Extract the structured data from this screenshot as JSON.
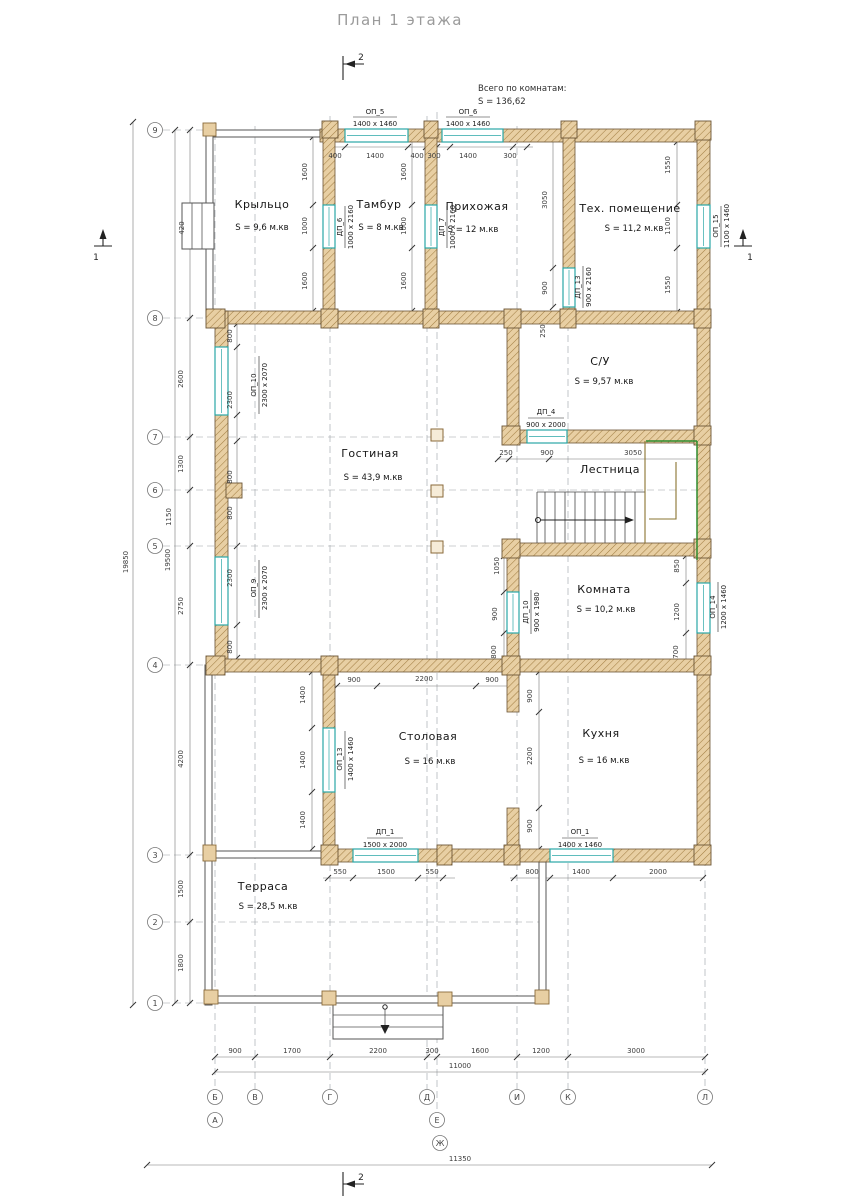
{
  "title": "План 1 этажа",
  "summary": {
    "line1": "Всего по комнатам:",
    "line2": "S   =   136,62"
  },
  "markers": {
    "top": "2",
    "bottom": "2",
    "right": "1",
    "left": "1"
  },
  "axes": {
    "rows": [
      "9",
      "8",
      "7",
      "6",
      "5",
      "4",
      "3",
      "2",
      "1"
    ],
    "cols": [
      "Б",
      "В",
      "Г",
      "Д",
      "И",
      "К",
      "Л"
    ],
    "cols_row2": [
      "А",
      "Е"
    ],
    "col_extra": "Ж"
  },
  "rooms": {
    "krylco": {
      "name": "Крыльцо",
      "area": "S  =  9,6 м.кв"
    },
    "tambur": {
      "name": "Тамбур",
      "area": "S  =  8 м.кв"
    },
    "prihozhaya": {
      "name": "Прихожая",
      "area": "S  =  12 м.кв"
    },
    "tehpom": {
      "name": "Тех. помещение",
      "area": "S  =  11,2 м.кв"
    },
    "su": {
      "name": "С/У",
      "area": "S  =  9,57 м.кв"
    },
    "gostinaya": {
      "name": "Гостиная",
      "area": "S  =  43,9 м.кв"
    },
    "lestnitsa": {
      "name": "Лестница"
    },
    "komnata": {
      "name": "Комната",
      "area": "S  =  10,2 м.кв"
    },
    "stolovaya": {
      "name": "Столовая",
      "area": "S  =  16 м.кв"
    },
    "kuhnya": {
      "name": "Кухня",
      "area": "S  =  16 м.кв"
    },
    "terrasa": {
      "name": "Терраса",
      "area": "S  =  28,5 м.кв"
    }
  },
  "openings": {
    "op5": {
      "name": "ОП_5",
      "size": "1400 x 1460"
    },
    "op6": {
      "name": "ОП_6",
      "size": "1400 x 1460"
    },
    "op15": {
      "name": "ОП_15",
      "size": "1100 x 1460"
    },
    "op10": {
      "name": "ОП_10",
      "size": "2300 x 2070"
    },
    "op9": {
      "name": "ОП_9",
      "size": "2300 x 2070"
    },
    "op14": {
      "name": "ОП_14",
      "size": "1200 x 1460"
    },
    "op13": {
      "name": "ОП_13",
      "size": "1400 x 1460"
    },
    "op1": {
      "name": "ОП_1",
      "size": "1400 x 1460"
    },
    "dp6": {
      "name": "ДП_6",
      "size": "1000 x 2160"
    },
    "dp7": {
      "name": "ДП_7",
      "size": "1000 x 2160"
    },
    "dp13": {
      "name": "ДП_13",
      "size": "900 x 2160"
    },
    "dp4": {
      "name": "ДП_4",
      "size": "900 x 2000"
    },
    "dp10": {
      "name": "ДП_10",
      "size": "900 x 1980"
    },
    "dp1": {
      "name": "ДП_1",
      "size": "1500 x 2000"
    }
  },
  "dims_h": [
    "400",
    "1400",
    "400",
    "300",
    "1400",
    "300",
    "250",
    "900",
    "3050",
    "900",
    "2200",
    "900",
    "550",
    "1500",
    "550",
    "800",
    "1400",
    "2000",
    "900",
    "1700",
    "2200",
    "300",
    "1600",
    "1200",
    "3000",
    "11000",
    "11350"
  ],
  "dims_v": [
    "1600",
    "1000",
    "1600",
    "1600",
    "1000",
    "1600",
    "3050",
    "900",
    "1550",
    "1100",
    "1550",
    "2600",
    "1300",
    "1150",
    "2750",
    "4200",
    "1500",
    "1800",
    "19500",
    "19850",
    "800",
    "2300",
    "800",
    "800",
    "2300",
    "800",
    "250",
    "1050",
    "900",
    "800",
    "850",
    "1200",
    "700",
    "1400",
    "1400",
    "1400",
    "900",
    "2200",
    "900",
    "420"
  ],
  "colors": {
    "wall_fill": "#e8cfa3",
    "hatch": "#a37f44",
    "opening": "#2aa7a7",
    "stair_green": "#2e8b2e",
    "dim_line": "#777777"
  }
}
